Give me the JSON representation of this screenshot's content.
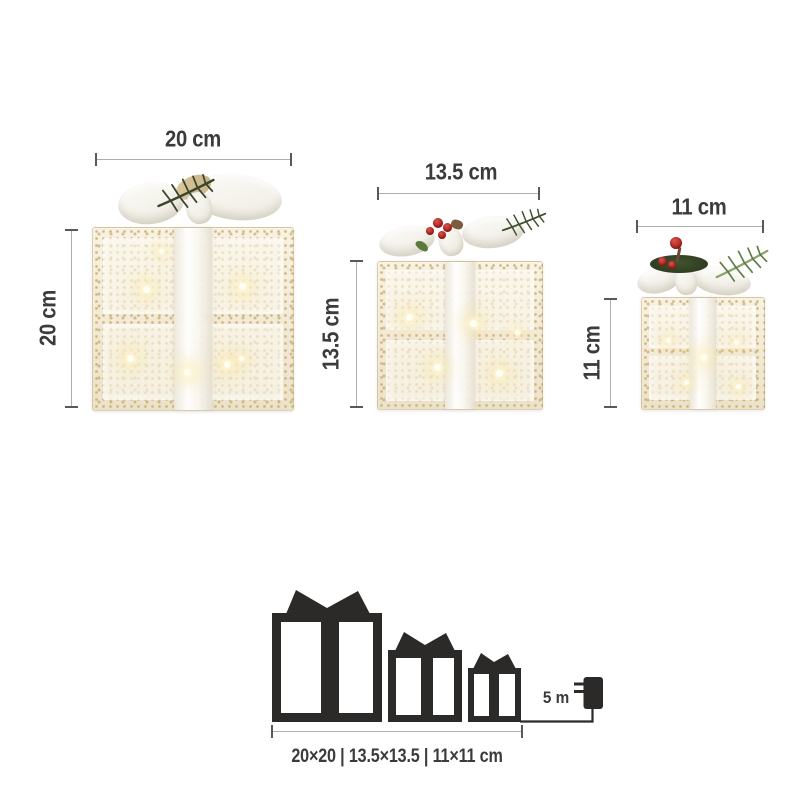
{
  "figures": [
    {
      "id": "large",
      "width_label": "20 cm",
      "height_label": "20 cm"
    },
    {
      "id": "medium",
      "width_label": "13.5 cm",
      "height_label": "13.5 cm"
    },
    {
      "id": "small",
      "width_label": "11 cm",
      "height_label": "11 cm"
    }
  ],
  "pictogram": {
    "cable_length_label": "5 m",
    "caption": "20×20 | 13.5×13.5 | 11×11 cm"
  },
  "colors": {
    "dimension_text": "#3b3b39",
    "dimension_line": "#adadab",
    "pictogram_black": "#2b2a28",
    "box_cream": "#f0e9d6",
    "sequin_gold": "#ceae6a",
    "bow_white": "#f7f5f0",
    "greenery_dark": "#3a462b",
    "greenery_light": "#8aa46b",
    "berry_red": "#a91f1b"
  }
}
